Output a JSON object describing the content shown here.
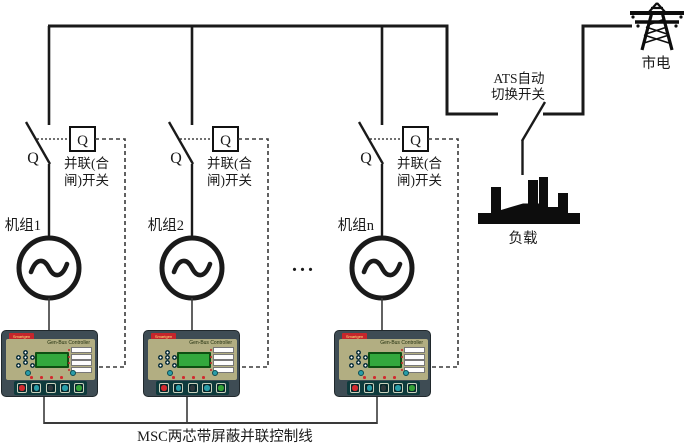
{
  "units": [
    {
      "name": "机组1",
      "blade_label": "Q",
      "box_label": "Q",
      "caption_line1": "并联(合",
      "caption_line2": "闸)开关"
    },
    {
      "name": "机组2",
      "blade_label": "Q",
      "box_label": "Q",
      "caption_line1": "并联(合",
      "caption_line2": "闸)开关"
    },
    {
      "name": "机组n",
      "blade_label": "Q",
      "box_label": "Q",
      "caption_line1": "并联(合",
      "caption_line2": "闸)开关"
    }
  ],
  "ellipsis": "...",
  "ats": {
    "label_line1": "ATS自动",
    "label_line2": "切换开关"
  },
  "utility": {
    "label": "市电"
  },
  "load": {
    "label": "负载"
  },
  "control_bus_caption": "MSC两芯带屏蔽并联控制线",
  "controller": {
    "brand": "Smartgen",
    "model": "Gen-Bus Controller"
  },
  "colors": {
    "wire": "#1a1a1a",
    "thin_wire": "#3a3a3a",
    "controller_frame": "#3e4c54",
    "controller_panel": "#b2ae82",
    "lcd_green": "#33a83d",
    "brand_badge_red": "#c5262c",
    "button_red": "#d22a2e",
    "button_teal": "#2a9da8",
    "button_dark": "#30383c",
    "button_green": "#35a338"
  }
}
